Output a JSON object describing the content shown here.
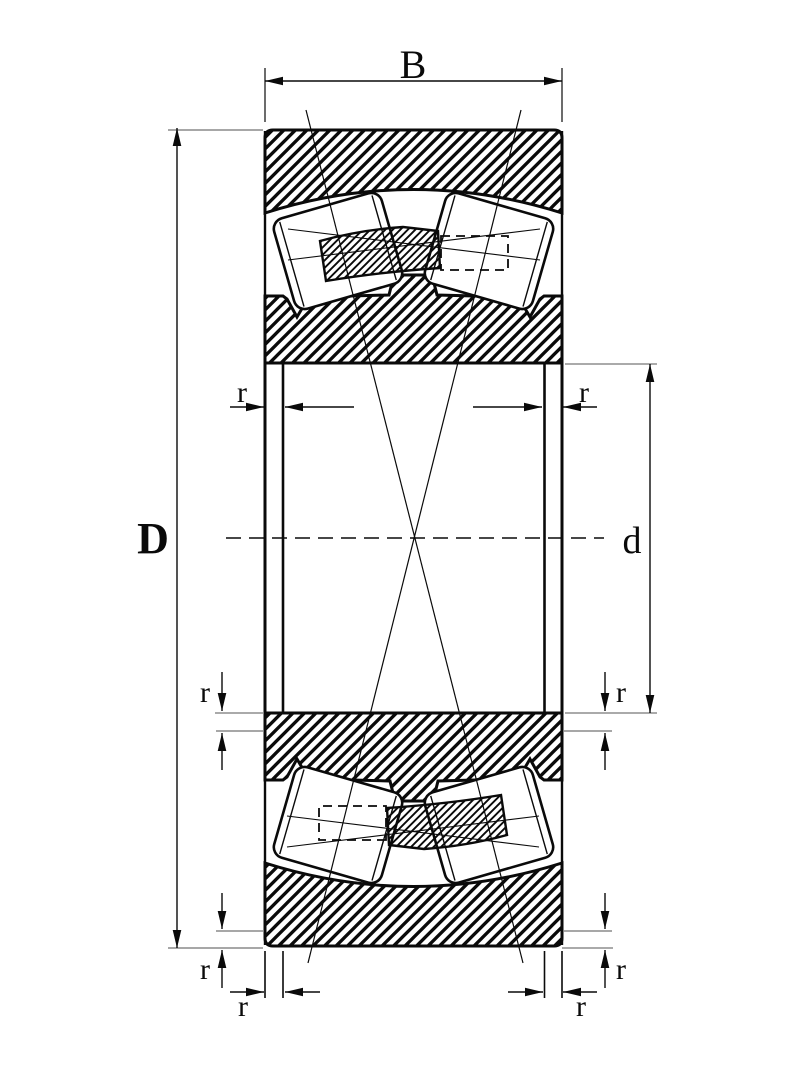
{
  "page": {
    "background": "#ffffff"
  },
  "drawing": {
    "kind": "spherical-roller-bearing-cross-section",
    "labels": {
      "width": "B",
      "outer_diameter": "D",
      "bore_diameter": "d",
      "chamfer_radius": "r"
    },
    "colors": {
      "line": "#0a0a0a",
      "extension_line": "#8a8a8a",
      "background": "#ffffff"
    }
  }
}
